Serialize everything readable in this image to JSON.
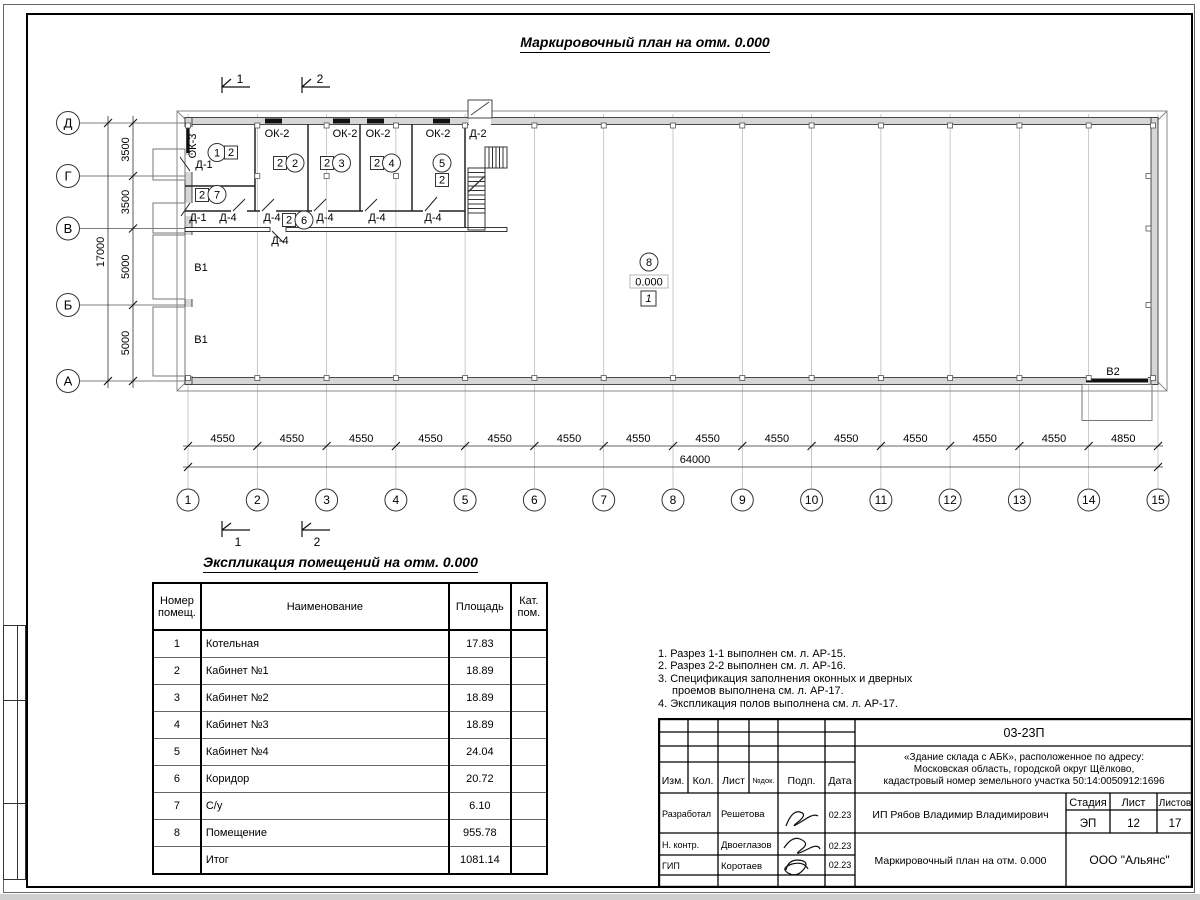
{
  "sheet": {
    "plan_title": "Маркировочный план на отм. 0.000",
    "table_title": "Экспликация помещений на отм. 0.000"
  },
  "plan": {
    "row_axes": [
      "Д",
      "Г",
      "В",
      "Б",
      "А"
    ],
    "row_dims": [
      "3500",
      "3500",
      "5000",
      "5000"
    ],
    "row_total": "17000",
    "cols": [
      "1",
      "2",
      "3",
      "4",
      "5",
      "6",
      "7",
      "8",
      "9",
      "10",
      "11",
      "12",
      "13",
      "14",
      "15"
    ],
    "col_dims": [
      "4550",
      "4550",
      "4550",
      "4550",
      "4550",
      "4550",
      "4550",
      "4550",
      "4550",
      "4550",
      "4550",
      "4550",
      "4550",
      "4850"
    ],
    "col_total": "64000",
    "cut1": "1",
    "cut2": "2",
    "ok2": "ОК-2",
    "ok3": "ОК-3",
    "d1": "Д-1",
    "d2": "Д-2",
    "d4": "Д-4",
    "v1": "В1",
    "v2": "В2",
    "level": "0.000",
    "floor_type": "1",
    "rooms": [
      "1",
      "2",
      "3",
      "4",
      "5",
      "6",
      "7",
      "8"
    ],
    "cat": "2"
  },
  "explication": {
    "headers": [
      "Номер помещ.",
      "Наименование",
      "Площадь",
      "Кат. пом."
    ],
    "rows": [
      {
        "num": "1",
        "name": "Котельная",
        "area": "17.83",
        "cat": ""
      },
      {
        "num": "2",
        "name": "Кабинет №1",
        "area": "18.89",
        "cat": ""
      },
      {
        "num": "3",
        "name": "Кабинет №2",
        "area": "18.89",
        "cat": ""
      },
      {
        "num": "4",
        "name": "Кабинет №3",
        "area": "18.89",
        "cat": ""
      },
      {
        "num": "5",
        "name": "Кабинет №4",
        "area": "24.04",
        "cat": ""
      },
      {
        "num": "6",
        "name": "Коридор",
        "area": "20.72",
        "cat": ""
      },
      {
        "num": "7",
        "name": "С/у",
        "area": "6.10",
        "cat": ""
      },
      {
        "num": "8",
        "name": "Помещение",
        "area": "955.78",
        "cat": ""
      },
      {
        "num": "",
        "name": "Итог",
        "area": "1081.14",
        "cat": ""
      }
    ]
  },
  "notes": {
    "lines": [
      "1. Разрез 1-1 выполнен см. л. АР-15.",
      "2. Разрез 2-2 выполнен см. л. АР-16.",
      "3. Спецификация заполнения оконных и дверных",
      "проемов выполнена см. л. АР-17.",
      "4. Экспликация полов выполнена см. л. АР-17."
    ]
  },
  "titleblock": {
    "doc_number": "03-23П",
    "project_lines": [
      "«Здание склада с АБК», расположенное по адресу:",
      "Московская область, городской округ Щёлково,",
      "кадастровый номер земельного участка 50:14:0050912:1696"
    ],
    "client": "ИП Рябов Владимир Владимирович",
    "sheet_name": "Маркировочный план на отм. 0.000",
    "organization": "ООО \"Альянс\"",
    "header_cols": [
      "Изм.",
      "Кол.",
      "Лист",
      "№док.",
      "Подп.",
      "Дата"
    ],
    "stage_label": "Стадия",
    "sheet_label": "Лист",
    "sheets_label": "Листов",
    "stage_value": "ЭП",
    "sheet_value": "12",
    "sheets_value": "17",
    "rows": [
      {
        "role": "Разработал",
        "name": "Решетова",
        "date": "02.23"
      },
      {
        "role": "Н. контр.",
        "name": "Двоеглазов",
        "date": "02.23"
      },
      {
        "role": "ГИП",
        "name": "Коротаев",
        "date": "02.23"
      }
    ]
  }
}
